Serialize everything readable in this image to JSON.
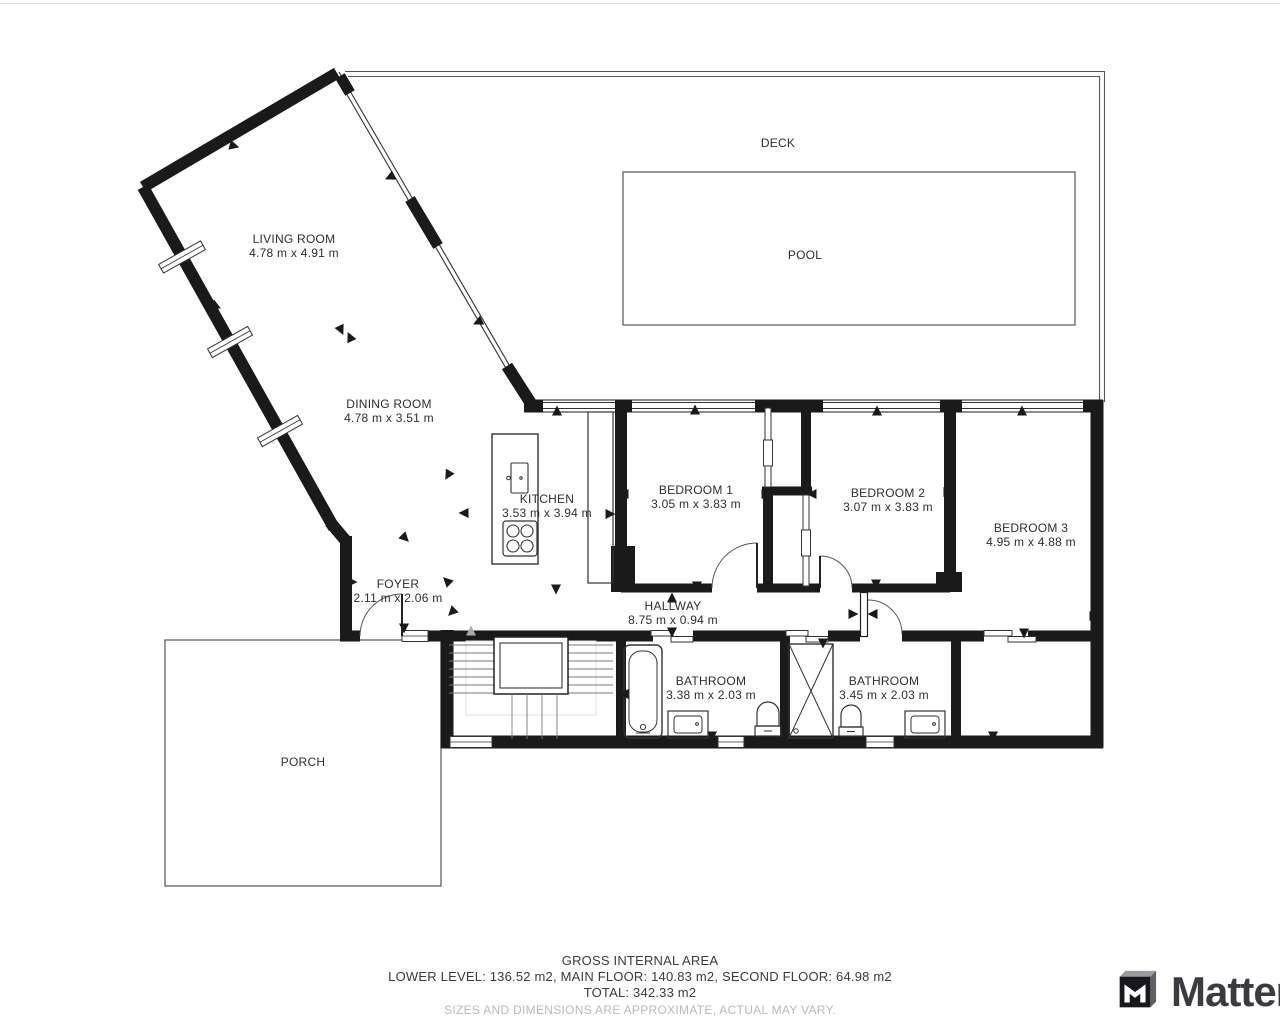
{
  "floor_plan": {
    "rooms": [
      {
        "id": "living-room",
        "name": "LIVING ROOM",
        "dims": "4.78 m x 4.91 m"
      },
      {
        "id": "dining-room",
        "name": "DINING ROOM",
        "dims": "4.78 m x 3.51 m"
      },
      {
        "id": "deck",
        "name": "DECK",
        "dims": ""
      },
      {
        "id": "pool",
        "name": "POOL",
        "dims": ""
      },
      {
        "id": "kitchen",
        "name": "KITCHEN",
        "dims": "3.53 m x 3.94 m"
      },
      {
        "id": "bedroom-1",
        "name": "BEDROOM 1",
        "dims": "3.05 m x 3.83 m"
      },
      {
        "id": "bedroom-2",
        "name": "BEDROOM 2",
        "dims": "3.07 m x 3.83 m"
      },
      {
        "id": "bedroom-3",
        "name": "BEDROOM 3",
        "dims": "4.95 m x 4.88 m"
      },
      {
        "id": "foyer",
        "name": "FOYER",
        "dims": "2.11 m x 2.06 m"
      },
      {
        "id": "hallway",
        "name": "HALLWAY",
        "dims": "8.75 m x 0.94 m"
      },
      {
        "id": "bathroom-1",
        "name": "BATHROOM",
        "dims": "3.38 m x 2.03 m"
      },
      {
        "id": "bathroom-2",
        "name": "BATHROOM",
        "dims": "3.45 m x 2.03 m"
      },
      {
        "id": "porch",
        "name": "PORCH",
        "dims": ""
      }
    ],
    "footer": {
      "title": "GROSS INTERNAL AREA",
      "levels": "LOWER LEVEL: 136.52 m2, MAIN FLOOR: 140.83 m2, SECOND FLOOR: 64.98 m2",
      "total": "TOTAL: 342.33 m2",
      "disclaimer": "SIZES AND DIMENSIONS ARE APPROXIMATE, ACTUAL MAY VARY."
    },
    "brand": {
      "logo_text": "Matterport"
    },
    "colors": {
      "wall": "#1a1a1a",
      "thin_line": "#555555",
      "label": "#2e2e2e",
      "disclaimer": "#b9b9b9",
      "logo_text": "#3a3a40"
    }
  }
}
